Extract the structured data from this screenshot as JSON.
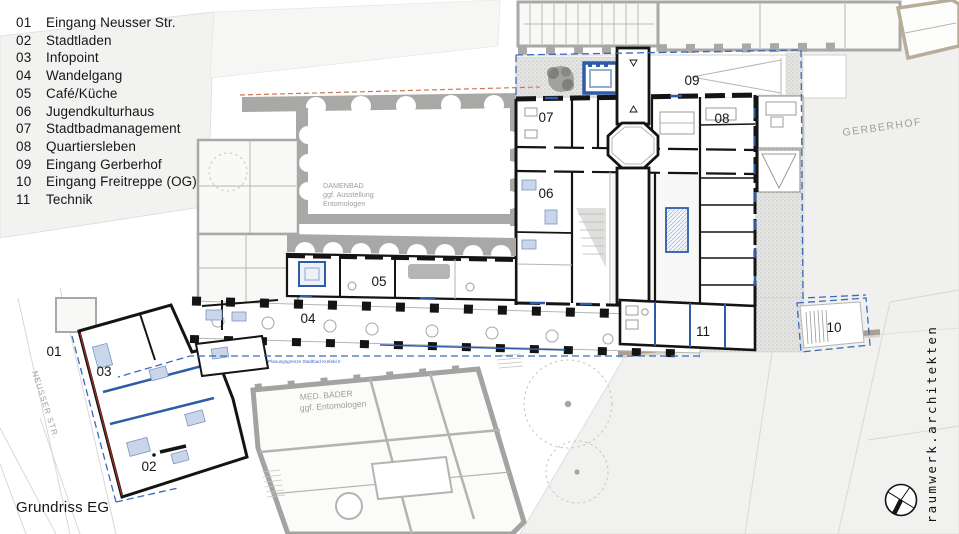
{
  "drawing_title": "Grundriss EG",
  "brand": "raumwerk.architekten",
  "legend": {
    "items": [
      {
        "num": "01",
        "label": "Eingang Neusser Str."
      },
      {
        "num": "02",
        "label": "Stadtladen"
      },
      {
        "num": "03",
        "label": "Infopoint"
      },
      {
        "num": "04",
        "label": "Wandelgang"
      },
      {
        "num": "05",
        "label": "Café/Küche"
      },
      {
        "num": "06",
        "label": "Jugendkulturhaus"
      },
      {
        "num": "07",
        "label": "Stadtbadmanagement"
      },
      {
        "num": "08",
        "label": "Quartiersleben"
      },
      {
        "num": "09",
        "label": "Eingang Gerberhof"
      },
      {
        "num": "10",
        "label": "Eingang Freitreppe (OG)"
      },
      {
        "num": "11",
        "label": "Technik"
      }
    ]
  },
  "plan": {
    "markers": [
      "01",
      "02",
      "03",
      "04",
      "05",
      "06",
      "07",
      "08",
      "09",
      "10",
      "11"
    ],
    "labels": {
      "damenbad": [
        "DAMENBAD",
        "ggf. Ausstellung",
        "Entomologen"
      ],
      "med_baeder": [
        "MED. BÄDER",
        "ggf. Entomologen"
      ],
      "gerberhof": "GERBERHOF",
      "neusser_str": "NEUSSER STR.",
      "planungsgrenze": "Planungsgrenze Stadtbad Krefeld II"
    }
  },
  "colors": {
    "new_wall": "#141414",
    "existing_wall": "#9b9b99",
    "accent_blue": "#2e5ca8",
    "boundary_blue": "#3a6ab8",
    "boundary_orange": "#c8795a",
    "facade_red": "#a83028",
    "parcel_fill": "#efefed",
    "tan_wall": "#a9a093"
  }
}
